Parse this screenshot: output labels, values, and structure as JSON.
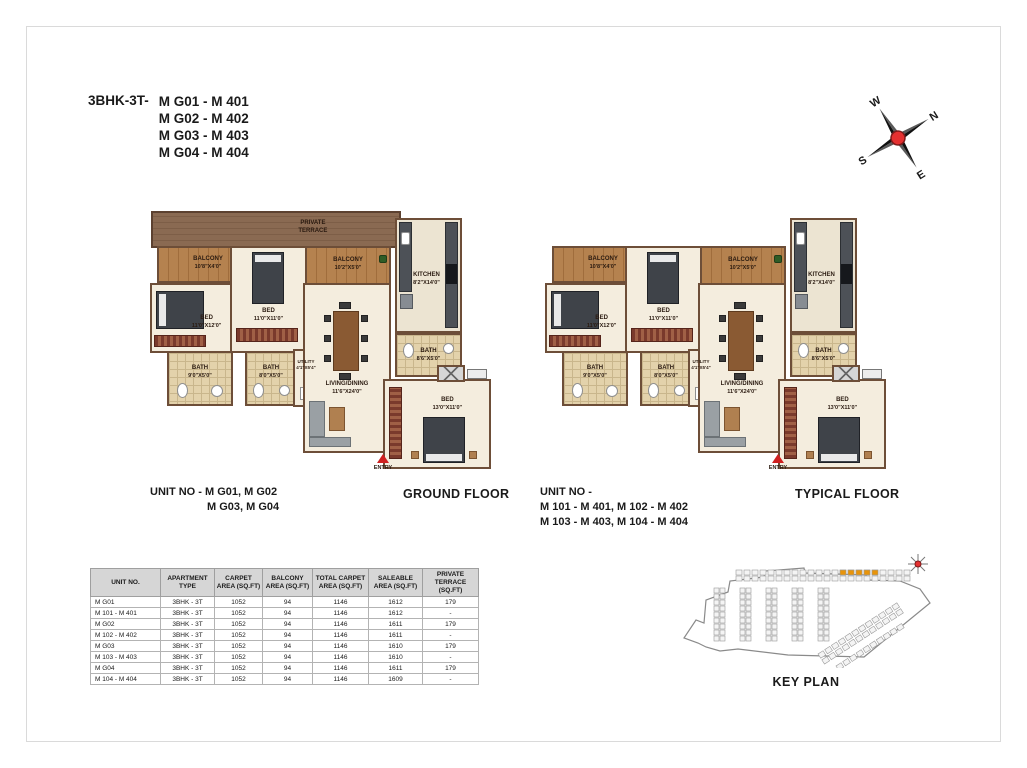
{
  "title": {
    "type_label": "3BHK-3T-",
    "unit_lines": [
      "M G01 - M 401",
      "M G02 - M 402",
      "M G03 - M 403",
      "M G04 - M 404"
    ]
  },
  "compass": {
    "north": "N",
    "south": "S",
    "east": "E",
    "west": "W"
  },
  "rooms": {
    "private_terrace": {
      "label": "PRIVATE",
      "label2": "TERRACE"
    },
    "balcony_left": {
      "label": "BALCONY",
      "dim": "10'8\"X4'0\""
    },
    "balcony_mid": {
      "label": "BALCONY",
      "dim": "10'2\"X5'0\""
    },
    "bed_mid": {
      "label": "BED",
      "dim": "11'0\"X11'0\""
    },
    "bed_left": {
      "label": "BED",
      "dim": "11'0\"X12'0\""
    },
    "bath_left": {
      "label": "BATH",
      "dim": "9'0\"X5'0\""
    },
    "bath_mid": {
      "label": "BATH",
      "dim": "8'0\"X5'0\""
    },
    "utility": {
      "label": "UTILITY",
      "dim": "4'1\"X5'4\""
    },
    "kitchen": {
      "label": "KITCHEN",
      "dim": "8'2\"X14'0\""
    },
    "living": {
      "label": "LIVING/DINING",
      "dim": "11'6\"X24'0\""
    },
    "bath_right": {
      "label": "BATH",
      "dim": "8'6\"X5'0\""
    },
    "bed_right": {
      "label": "BED",
      "dim": "13'0\"X11'0\""
    },
    "entry": {
      "label": "ENTRY"
    }
  },
  "plans": [
    {
      "floor_label": "GROUND FLOOR",
      "unit_no_lines": [
        "UNIT NO - M G01, M G02",
        "M G03, M G04"
      ]
    },
    {
      "floor_label": "TYPICAL FLOOR",
      "unit_no_lines": [
        "UNIT NO -",
        "M 101 - M 401, M 102 - M 402",
        "M 103 - M 403, M 104 - M 404"
      ]
    }
  ],
  "table": {
    "headers": [
      "UNIT NO.",
      "APARTMENT TYPE",
      "CARPET AREA (SQ.FT)",
      "BALCONY AREA (SQ.FT)",
      "TOTAL CARPET AREA (SQ.FT)",
      "SALEABLE AREA (SQ.FT)",
      "PRIVATE TERRACE (SQ.FT)"
    ],
    "rows": [
      [
        "M G01",
        "3BHK - 3T",
        "1052",
        "94",
        "1146",
        "1612",
        "179"
      ],
      [
        "M 101 - M 401",
        "3BHK - 3T",
        "1052",
        "94",
        "1146",
        "1612",
        "-"
      ],
      [
        "M G02",
        "3BHK - 3T",
        "1052",
        "94",
        "1146",
        "1611",
        "179"
      ],
      [
        "M 102 - M 402",
        "3BHK - 3T",
        "1052",
        "94",
        "1146",
        "1611",
        "-"
      ],
      [
        "M G03",
        "3BHK - 3T",
        "1052",
        "94",
        "1146",
        "1610",
        "179"
      ],
      [
        "M 103 - M 403",
        "3BHK - 3T",
        "1052",
        "94",
        "1146",
        "1610",
        "-"
      ],
      [
        "M G04",
        "3BHK - 3T",
        "1052",
        "94",
        "1146",
        "1611",
        "179"
      ],
      [
        "M 104 - M 404",
        "3BHK - 3T",
        "1052",
        "94",
        "1146",
        "1609",
        "-"
      ]
    ]
  },
  "key_plan": {
    "label": "KEY PLAN"
  },
  "colors": {
    "accent_red": "#cf2020",
    "highlight_orange": "#e8940a",
    "wall_brown": "#6d4e38"
  }
}
